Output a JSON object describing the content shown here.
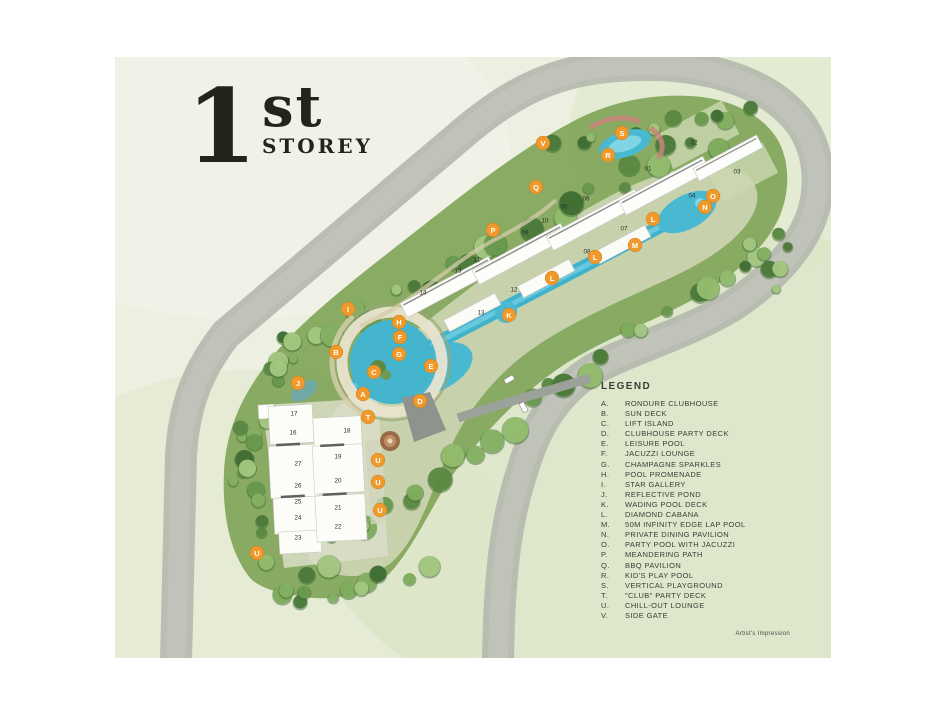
{
  "page": {
    "title": {
      "number": "1",
      "suffix": "st",
      "word": "STOREY"
    },
    "credit": "Artist's Impression"
  },
  "legend": {
    "heading": "LEGEND",
    "items": [
      {
        "key": "A.",
        "label": "RONDURE CLUBHOUSE"
      },
      {
        "key": "B.",
        "label": "SUN DECK"
      },
      {
        "key": "C.",
        "label": "LIFT ISLAND"
      },
      {
        "key": "D.",
        "label": "CLUBHOUSE PARTY DECK"
      },
      {
        "key": "E.",
        "label": "LEISURE POOL"
      },
      {
        "key": "F.",
        "label": "JACUZZI LOUNGE"
      },
      {
        "key": "G.",
        "label": "CHAMPAGNE SPARKLES"
      },
      {
        "key": "H.",
        "label": "POOL PROMENADE"
      },
      {
        "key": "I.",
        "label": "STAR GALLERY"
      },
      {
        "key": "J.",
        "label": "REFLECTIVE POND"
      },
      {
        "key": "K.",
        "label": "WADING POOL DECK"
      },
      {
        "key": "L.",
        "label": "DIAMOND CABANA"
      },
      {
        "key": "M.",
        "label": "50M INFINITY EDGE LAP POOL"
      },
      {
        "key": "N.",
        "label": "PRIVATE DINING PAVILION"
      },
      {
        "key": "O.",
        "label": "PARTY POOL WITH JACUZZI"
      },
      {
        "key": "P.",
        "label": "MEANDERING PATH"
      },
      {
        "key": "Q.",
        "label": "BBQ PAVILION"
      },
      {
        "key": "R.",
        "label": "KID'S PLAY POOL"
      },
      {
        "key": "S.",
        "label": "VERTICAL PLAYGROUND"
      },
      {
        "key": "T.",
        "label": "\"CLUB\" PARTY DECK"
      },
      {
        "key": "U.",
        "label": "CHILL-OUT LOUNGE"
      },
      {
        "key": "V.",
        "label": "SIDE GATE"
      }
    ]
  },
  "map": {
    "colors": {
      "road": "#b5b9af",
      "water": "#49b9d1",
      "canopy": "#7ba356",
      "background_wash": "#edf0e1",
      "marker": "#f09a2c",
      "ink": "#3b3e36"
    },
    "markers": [
      {
        "letter": "A",
        "x": 363,
        "y": 394
      },
      {
        "letter": "B",
        "x": 336,
        "y": 352
      },
      {
        "letter": "C",
        "x": 374,
        "y": 372
      },
      {
        "letter": "D",
        "x": 420,
        "y": 401
      },
      {
        "letter": "E",
        "x": 431,
        "y": 366
      },
      {
        "letter": "F",
        "x": 400,
        "y": 337
      },
      {
        "letter": "G",
        "x": 399,
        "y": 354
      },
      {
        "letter": "H",
        "x": 399,
        "y": 322
      },
      {
        "letter": "I",
        "x": 348,
        "y": 309
      },
      {
        "letter": "J",
        "x": 298,
        "y": 383
      },
      {
        "letter": "K",
        "x": 509,
        "y": 315
      },
      {
        "letter": "L",
        "x": 552,
        "y": 278
      },
      {
        "letter": "L",
        "x": 595,
        "y": 257
      },
      {
        "letter": "L",
        "x": 653,
        "y": 219
      },
      {
        "letter": "M",
        "x": 635,
        "y": 245
      },
      {
        "letter": "N",
        "x": 705,
        "y": 207
      },
      {
        "letter": "O",
        "x": 713,
        "y": 196
      },
      {
        "letter": "P",
        "x": 493,
        "y": 230
      },
      {
        "letter": "Q",
        "x": 536,
        "y": 187
      },
      {
        "letter": "R",
        "x": 608,
        "y": 155
      },
      {
        "letter": "S",
        "x": 622,
        "y": 133
      },
      {
        "letter": "T",
        "x": 368,
        "y": 417
      },
      {
        "letter": "U",
        "x": 378,
        "y": 460
      },
      {
        "letter": "U",
        "x": 378,
        "y": 482
      },
      {
        "letter": "U",
        "x": 380,
        "y": 510
      },
      {
        "letter": "U",
        "x": 257,
        "y": 553
      },
      {
        "letter": "V",
        "x": 543,
        "y": 143
      }
    ],
    "stacks": [
      {
        "num": "01",
        "x": 648,
        "y": 169
      },
      {
        "num": "02",
        "x": 694,
        "y": 143
      },
      {
        "num": "03",
        "x": 737,
        "y": 172
      },
      {
        "num": "04",
        "x": 692,
        "y": 196
      },
      {
        "num": "05",
        "x": 564,
        "y": 207
      },
      {
        "num": "06",
        "x": 586,
        "y": 199
      },
      {
        "num": "07",
        "x": 624,
        "y": 229
      },
      {
        "num": "08",
        "x": 587,
        "y": 252
      },
      {
        "num": "09",
        "x": 525,
        "y": 233
      },
      {
        "num": "10",
        "x": 545,
        "y": 221
      },
      {
        "num": "11",
        "x": 477,
        "y": 260
      },
      {
        "num": "12",
        "x": 514,
        "y": 290
      },
      {
        "num": "13",
        "x": 481,
        "y": 313
      },
      {
        "num": "14",
        "x": 423,
        "y": 293
      },
      {
        "num": "15",
        "x": 458,
        "y": 271
      },
      {
        "num": "16",
        "x": 293,
        "y": 433
      },
      {
        "num": "17",
        "x": 294,
        "y": 414
      },
      {
        "num": "18",
        "x": 347,
        "y": 431
      },
      {
        "num": "19",
        "x": 338,
        "y": 457
      },
      {
        "num": "20",
        "x": 338,
        "y": 481
      },
      {
        "num": "21",
        "x": 338,
        "y": 508
      },
      {
        "num": "22",
        "x": 338,
        "y": 527
      },
      {
        "num": "23",
        "x": 298,
        "y": 538
      },
      {
        "num": "24",
        "x": 298,
        "y": 518
      },
      {
        "num": "25",
        "x": 298,
        "y": 502
      },
      {
        "num": "26",
        "x": 298,
        "y": 486
      },
      {
        "num": "27",
        "x": 298,
        "y": 464
      }
    ]
  }
}
